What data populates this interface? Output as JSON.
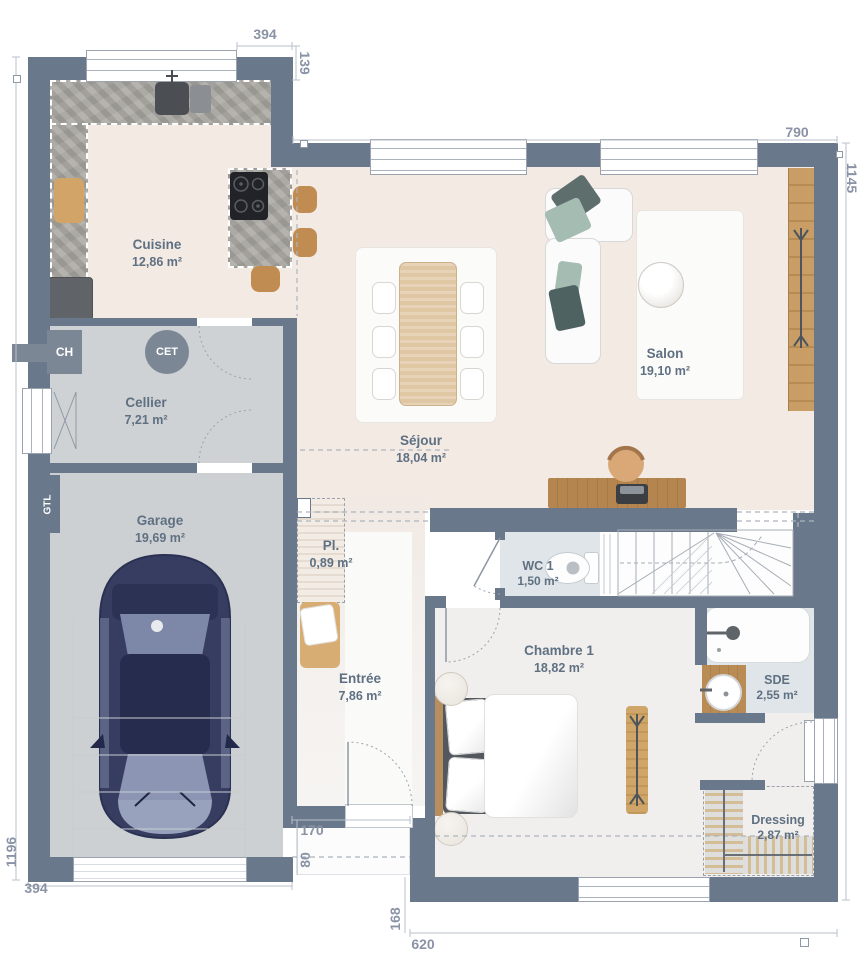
{
  "plan": {
    "rooms": {
      "cuisine": {
        "name": "Cuisine",
        "area": "12,86 m²"
      },
      "cellier": {
        "name": "Cellier",
        "area": "7,21 m²"
      },
      "garage": {
        "name": "Garage",
        "area": "19,69 m²"
      },
      "sejour": {
        "name": "Séjour",
        "area": "18,04 m²"
      },
      "salon": {
        "name": "Salon",
        "area": "19,10 m²"
      },
      "placard": {
        "name": "Pl.",
        "area": "0,89 m²"
      },
      "entree": {
        "name": "Entrée",
        "area": "7,86 m²"
      },
      "wc1": {
        "name": "WC 1",
        "area": "1,50 m²"
      },
      "chambre1": {
        "name": "Chambre 1",
        "area": "18,82 m²"
      },
      "sde": {
        "name": "SDE",
        "area": "2,55 m²"
      },
      "dressing": {
        "name": "Dressing",
        "area": "2,87 m²"
      }
    },
    "marks": {
      "ch": "CH",
      "cet": "CET",
      "gtl": "GTL"
    },
    "dims": {
      "kitchen_top_width": "394",
      "kitchen_right_offset": "139",
      "living_top_width": "790",
      "right_height": "1145",
      "left_height": "1196",
      "garage_bottom_width": "394",
      "porch_width": "170",
      "porch_depth": "80",
      "chambre_left_offset": "168",
      "chambre_bottom_width": "620"
    },
    "colors": {
      "wall": "#69788b",
      "floor_main": "#f2eae3",
      "floor_service": "#cdd0d2",
      "floor_wet": "#dfe5e8",
      "floor_bedroom": "#f1efed",
      "wood": "#c79d66",
      "label_text": "#5f7082",
      "dim_text": "#8a93a6"
    }
  }
}
